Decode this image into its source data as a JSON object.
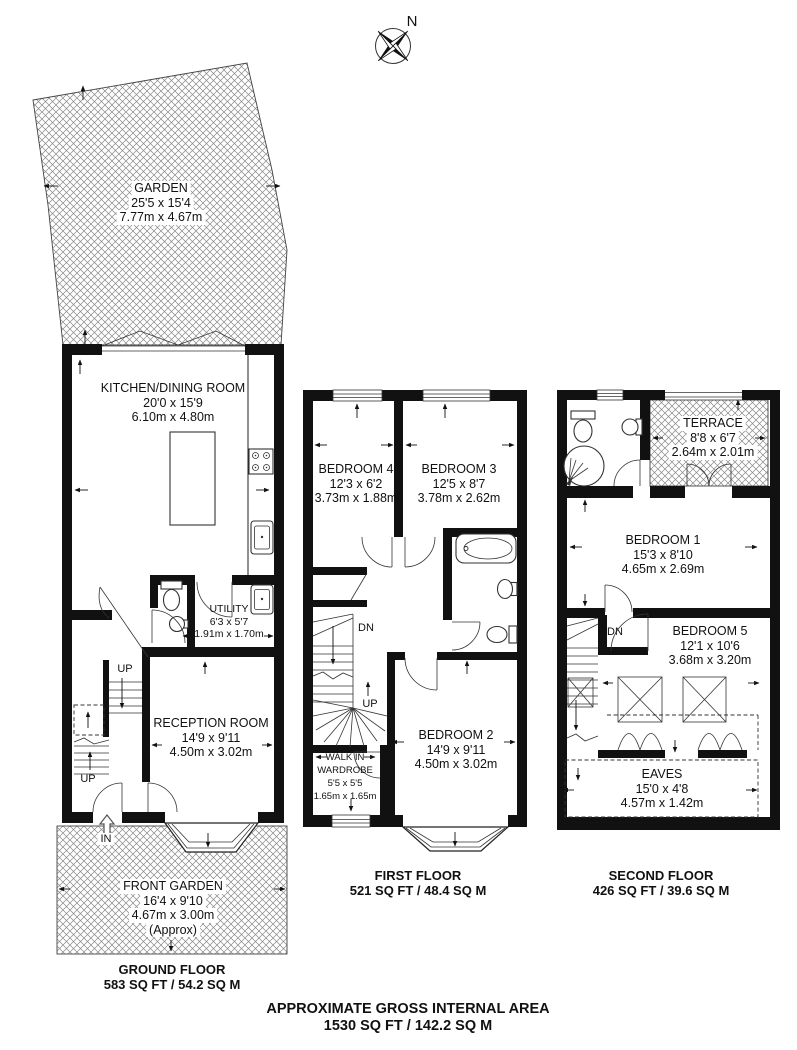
{
  "page": {
    "footer_line1": "APPROXIMATE GROSS INTERNAL AREA",
    "footer_line2": "1530 SQ FT / 142.2 SQ M"
  },
  "compass": {
    "north": "N"
  },
  "ground": {
    "title": "GROUND FLOOR",
    "area": "583 SQ FT / 54.2 SQ M",
    "garden": {
      "name": "GARDEN",
      "imp": "25'5 x 15'4",
      "met": "7.77m x 4.67m"
    },
    "kitchen": {
      "name": "KITCHEN/DINING ROOM",
      "imp": "20'0 x 15'9",
      "met": "6.10m x 4.80m"
    },
    "utility": {
      "name": "UTILITY",
      "imp": "6'3 x 5'7",
      "met": "1.91m x 1.70m"
    },
    "reception": {
      "name": "RECEPTION ROOM",
      "imp": "14'9 x 9'11",
      "met": "4.50m x 3.02m"
    },
    "front_garden": {
      "name": "FRONT GARDEN",
      "imp": "16'4 x 9'10",
      "met": "4.67m x 3.00m",
      "note": "(Approx)"
    },
    "up1": "UP",
    "up2": "UP",
    "in_label": "IN"
  },
  "first": {
    "title": "FIRST FLOOR",
    "area": "521 SQ FT / 48.4 SQ M",
    "bedroom4": {
      "name": "BEDROOM 4",
      "imp": "12'3 x 6'2",
      "met": "3.73m x 1.88m"
    },
    "bedroom3": {
      "name": "BEDROOM 3",
      "imp": "12'5 x 8'7",
      "met": "3.78m x 2.62m"
    },
    "bedroom2": {
      "name": "BEDROOM 2",
      "imp": "14'9 x 9'11",
      "met": "4.50m x 3.02m"
    },
    "wardrobe": {
      "line1": "WALK IN",
      "line2": "WARDROBE",
      "imp": "5'5 x 5'5",
      "met": "1.65m x 1.65m"
    },
    "dn": "DN",
    "up": "UP"
  },
  "second": {
    "title": "SECOND FLOOR",
    "area": "426 SQ FT / 39.6 SQ M",
    "terrace": {
      "name": "TERRACE",
      "imp": "8'8 x 6'7",
      "met": "2.64m x 2.01m"
    },
    "bedroom1": {
      "name": "BEDROOM 1",
      "imp": "15'3 x 8'10",
      "met": "4.65m x 2.69m"
    },
    "bedroom5": {
      "name": "BEDROOM 5",
      "imp": "12'1 x 10'6",
      "met": "3.68m x 3.20m"
    },
    "eaves": {
      "name": "EAVES",
      "imp": "15'0 x 4'8",
      "met": "4.57m x 1.42m"
    },
    "dn": "DN"
  }
}
